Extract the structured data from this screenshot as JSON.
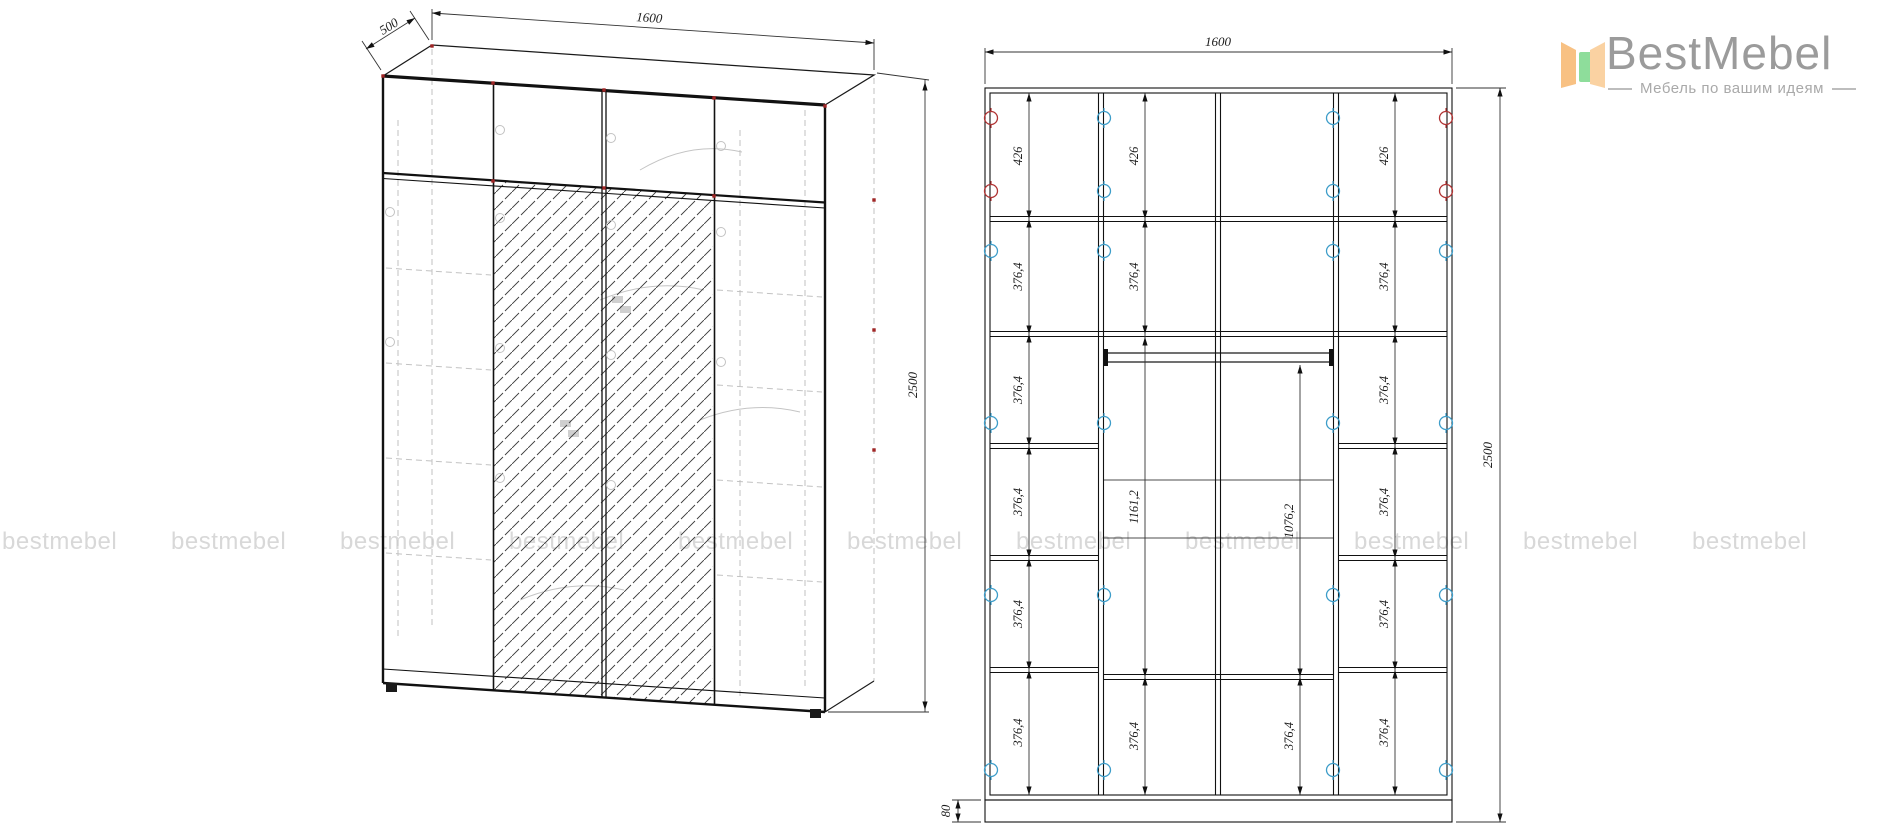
{
  "page": {
    "background": "#ffffff"
  },
  "logo": {
    "brand": "BestMebel",
    "tagline": "Мебель по вашим идеям",
    "icon_colors": {
      "left": "#f8c183",
      "middle": "#8edd9b",
      "right": "#fad2a2"
    },
    "text_color": "#9b9b9b"
  },
  "watermark": {
    "text": "bestmebel",
    "count": 11,
    "color": "#d8d8d8"
  },
  "drawing_colors": {
    "line": "#111111",
    "hidden_line": "#c2c2c2",
    "hinge_red": "#b03434",
    "hinge_blue": "#3d9dc9",
    "dim_text": "#1c1c1c"
  },
  "left_view": {
    "title": "wardrobe-3d-isometric-view",
    "depth_label": "500",
    "width_label": "1600",
    "height_label": "2500"
  },
  "right_view": {
    "title": "wardrobe-front-elevation",
    "width_label": "1600",
    "height_label": "2500",
    "plinth_label": "80",
    "col1_labels": [
      "426",
      "376,4",
      "376,4",
      "376,4",
      "376,4",
      "376,4"
    ],
    "col2_labels": [
      "426",
      "376,4",
      "1161,2",
      "376,4"
    ],
    "col3_labels": [
      "1076,2",
      "376,4"
    ],
    "col4_labels": [
      "426",
      "376,4",
      "376,4",
      "376,4",
      "376,4",
      "376,4"
    ]
  }
}
